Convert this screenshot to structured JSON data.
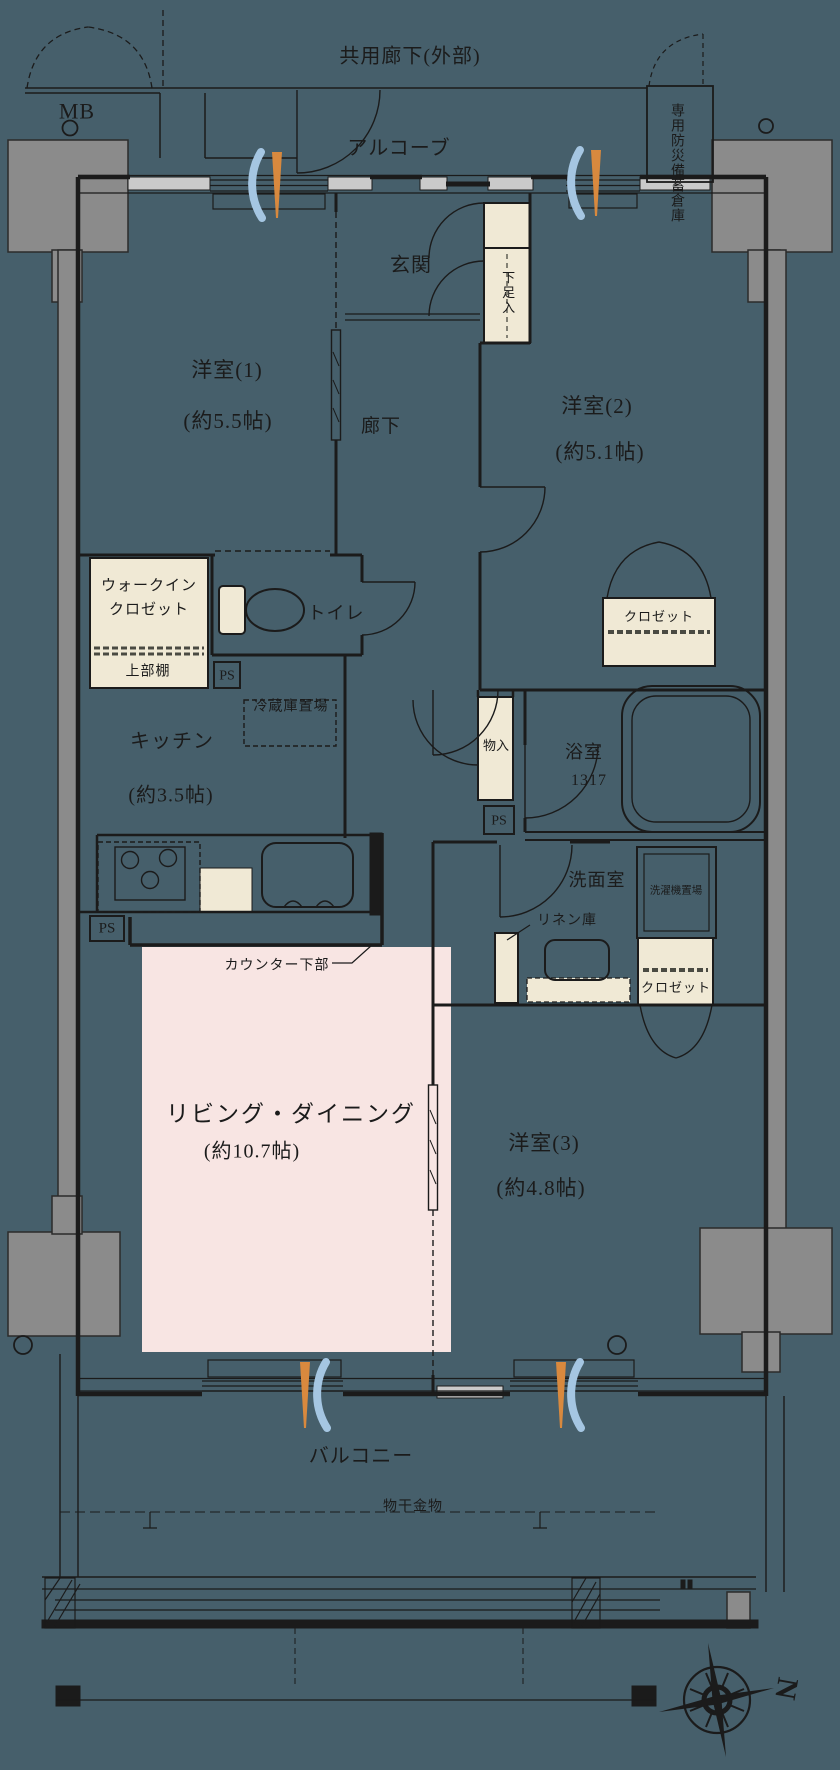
{
  "title": "マンション間取り図 3LDK",
  "colors": {
    "background": "#465f6b",
    "line": "#1b1b1b",
    "cream_fixture": "#f0e9d5",
    "living_pink": "#f8e5e3",
    "concrete_gray": "#8b8b8b",
    "sill_gray": "#cacaca",
    "vent_blue": "#a5c6e2",
    "vent_orange": "#d8893e"
  },
  "labels": {
    "corridor": "共用廊下(外部)",
    "mb": "MB",
    "alcove": "アルコーブ",
    "storage": "専用防災備蓄倉庫",
    "genkan": "玄関",
    "shoe": "下足入",
    "room1": "洋室(1)",
    "room1_size": "(約5.5帖)",
    "room2": "洋室(2)",
    "room2_size": "(約5.1帖)",
    "hall": "廊下",
    "wic": "ウォークイン\nクロゼット",
    "shelf": "上部棚",
    "toilet": "トイレ",
    "ps": "PS",
    "fridge": "冷蔵庫置場",
    "kitchen": "キッチン",
    "kitchen_size": "(約3.5帖)",
    "closet": "クロゼット",
    "mono": "物入",
    "bath": "浴室",
    "bath_size": "1317",
    "wash": "洗面室",
    "laundry": "洗濯機置場",
    "linen": "リネン庫",
    "counter": "カウンター下部",
    "ld": "リビング・ダイニング",
    "ld_size": "(約10.7帖)",
    "room3": "洋室(3)",
    "room3_size": "(約4.8帖)",
    "balcony": "バルコニー",
    "hanger": "物干金物",
    "north": "N"
  }
}
